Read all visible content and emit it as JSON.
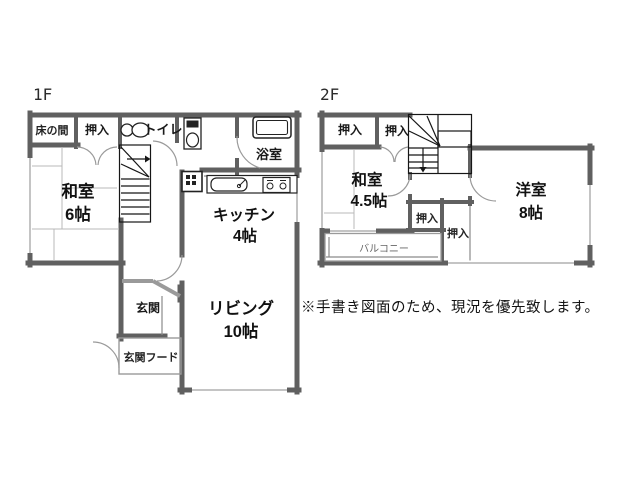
{
  "note": "※手書き図面のため、現況を優先致します。",
  "floors": {
    "f1": {
      "label": "1F",
      "rooms": {
        "tokonoma": "床の間",
        "oshiire": "押入",
        "toilet": "トイレ",
        "bath": "浴室",
        "washitsu": "和室",
        "washitsu_size": "6帖",
        "kitchen": "キッチン",
        "kitchen_size": "4帖",
        "living": "リビング",
        "living_size": "10帖",
        "genkan": "玄関",
        "genkan_hood": "玄関フード"
      }
    },
    "f2": {
      "label": "2F",
      "rooms": {
        "oshiire_a": "押入",
        "oshiire_b": "押入",
        "oshiire_c": "押入",
        "oshiire_d": "押入",
        "washitsu": "和室",
        "washitsu_size": "4.5帖",
        "youshitsu": "洋室",
        "youshitsu_size": "8帖",
        "balcony": "バルコニー"
      }
    }
  },
  "colors": {
    "wall": "#606060",
    "stairs": "#161616",
    "text": "#111111",
    "background": "#ffffff"
  }
}
